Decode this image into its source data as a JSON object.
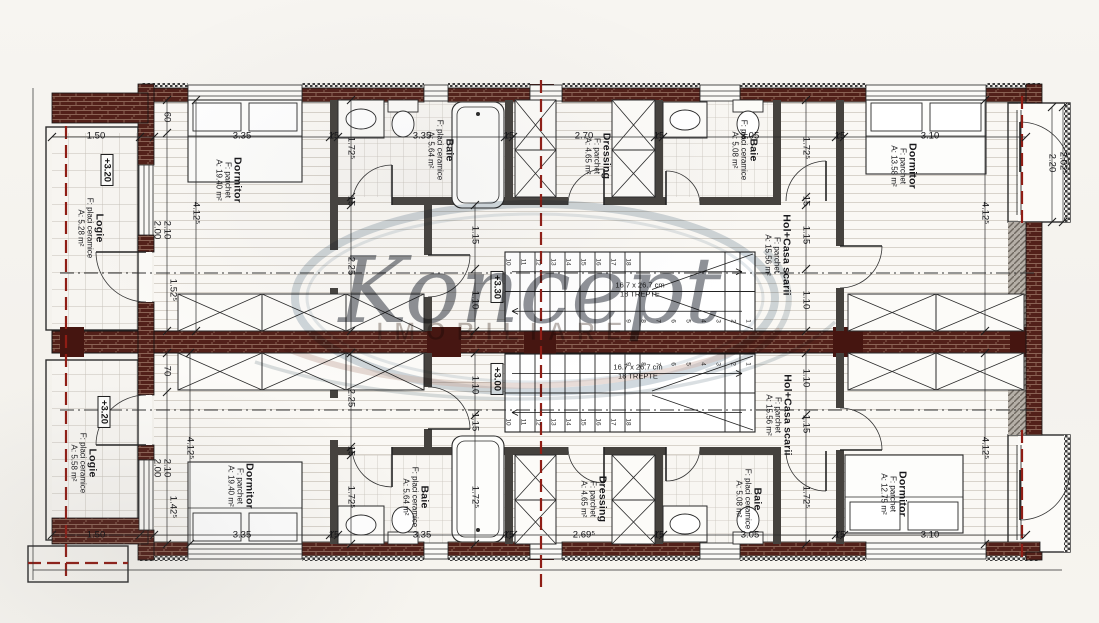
{
  "watermark": {
    "brand": "Koncept",
    "subtitle": "IMOBILIARE"
  },
  "plan": {
    "rooms": [
      {
        "id": "logie-top",
        "name": "Logie",
        "finish": "F: placi ceramice",
        "area": "A: 5.28 m²",
        "x": 90,
        "y": 228
      },
      {
        "id": "dormitor-top-left",
        "name": "Dormitor",
        "finish": "F: parchet",
        "area": "A: 19.40 m²",
        "x": 228,
        "y": 180
      },
      {
        "id": "baie-top-1",
        "name": "Baie",
        "finish": "F: placi ceramice",
        "area": "A: 5.64 m²",
        "x": 440,
        "y": 150
      },
      {
        "id": "dressing-top",
        "name": "Dressing",
        "finish": "F: parchet",
        "area": "A: 4.65 m²",
        "x": 597,
        "y": 156
      },
      {
        "id": "baie-top-2",
        "name": "Baie",
        "finish": "F: placi ceramice",
        "area": "A: 5.08 m²",
        "x": 744,
        "y": 150
      },
      {
        "id": "hol-top",
        "name": "Hol+Casa scarii",
        "finish": "F: parchet",
        "area": "A: 15.56 m²",
        "x": 777,
        "y": 255
      },
      {
        "id": "dormitor-top-right",
        "name": "Dormitor",
        "finish": "F: parchet",
        "area": "A: 13.58 m²",
        "x": 903,
        "y": 166
      },
      {
        "id": "logie-bottom",
        "name": "Logie",
        "finish": "F: placi ceramice",
        "area": "A: 5.58 m²",
        "x": 83,
        "y": 463
      },
      {
        "id": "dormitor-bottom-left",
        "name": "Dormitor",
        "finish": "F: parchet",
        "area": "A: 19.40 m²",
        "x": 240,
        "y": 486
      },
      {
        "id": "baie-bottom-1",
        "name": "Baie",
        "finish": "F: placi ceramice",
        "area": "A: 5.64 m²",
        "x": 415,
        "y": 497
      },
      {
        "id": "dressing-bottom",
        "name": "Dressing",
        "finish": "F: parchet",
        "area": "A: 4.65 m²",
        "x": 593,
        "y": 499
      },
      {
        "id": "baie-bottom-2",
        "name": "Baie",
        "finish": "F: placi ceramice",
        "area": "A: 5.08 m²",
        "x": 748,
        "y": 499
      },
      {
        "id": "hol-bottom",
        "name": "Hol+Casa scarii",
        "finish": "F: parchet",
        "area": "A: 15.56 m²",
        "x": 778,
        "y": 415
      },
      {
        "id": "dormitor-bottom-right",
        "name": "Dormitor",
        "finish": "F: parchet",
        "area": "A: 12.75 m²",
        "x": 893,
        "y": 494
      }
    ],
    "levels": [
      {
        "text": "+3.20",
        "x": 107,
        "y": 170
      },
      {
        "text": "+3.30",
        "x": 497,
        "y": 287
      },
      {
        "text": "+3.00",
        "x": 497,
        "y": 379
      },
      {
        "text": "+3.20",
        "x": 104,
        "y": 412
      }
    ],
    "stairs": {
      "tread_label": "16.7 x 26.7 cm",
      "steps_label": "18 TREPTE",
      "tread_count": 18,
      "notes": [
        {
          "x": 640,
          "y": 290
        },
        {
          "x": 638,
          "y": 372
        }
      ]
    },
    "dimensions": [
      {
        "t": "1.50",
        "x": 96,
        "y": 136
      },
      {
        "t": "3.35",
        "x": 242,
        "y": 136
      },
      {
        "t": "15",
        "x": 334,
        "y": 136
      },
      {
        "t": "3.35",
        "x": 422,
        "y": 136
      },
      {
        "t": "15",
        "x": 509,
        "y": 136
      },
      {
        "t": "2.70",
        "x": 584,
        "y": 136
      },
      {
        "t": "15",
        "x": 659,
        "y": 136
      },
      {
        "t": "3.05",
        "x": 750,
        "y": 136
      },
      {
        "t": "15",
        "x": 840,
        "y": 136
      },
      {
        "t": "3.10",
        "x": 930,
        "y": 136
      },
      {
        "t": "1.50",
        "x": 96,
        "y": 535
      },
      {
        "t": "3.35",
        "x": 242,
        "y": 535
      },
      {
        "t": "15",
        "x": 334,
        "y": 535
      },
      {
        "t": "3.35",
        "x": 422,
        "y": 535
      },
      {
        "t": "15",
        "x": 509,
        "y": 535
      },
      {
        "t": "2.69⁵",
        "x": 584,
        "y": 535
      },
      {
        "t": "15",
        "x": 659,
        "y": 535
      },
      {
        "t": "3.05",
        "x": 750,
        "y": 535
      },
      {
        "t": "15",
        "x": 840,
        "y": 535
      },
      {
        "t": "3.10",
        "x": 930,
        "y": 535
      },
      {
        "t": "60",
        "x": 167,
        "y": 117,
        "r": 1
      },
      {
        "t": "2.00",
        "x": 157,
        "y": 230,
        "r": 1
      },
      {
        "t": "2.10",
        "x": 167,
        "y": 230,
        "r": 1
      },
      {
        "t": "4.12⁵",
        "x": 196,
        "y": 213,
        "r": 1
      },
      {
        "t": "1.52⁵",
        "x": 173,
        "y": 290,
        "r": 1
      },
      {
        "t": "1.72⁵",
        "x": 351,
        "y": 148,
        "r": 1
      },
      {
        "t": "15",
        "x": 351,
        "y": 201,
        "r": 1
      },
      {
        "t": "2.25",
        "x": 351,
        "y": 266,
        "r": 1
      },
      {
        "t": "1.15",
        "x": 475,
        "y": 235,
        "r": 1
      },
      {
        "t": "1.10",
        "x": 475,
        "y": 300,
        "r": 1
      },
      {
        "t": "1.72⁵",
        "x": 806,
        "y": 148,
        "r": 1
      },
      {
        "t": "15",
        "x": 806,
        "y": 201,
        "r": 1
      },
      {
        "t": "1.15",
        "x": 806,
        "y": 235,
        "r": 1
      },
      {
        "t": "1.10",
        "x": 806,
        "y": 300,
        "r": 1
      },
      {
        "t": "4.12⁵",
        "x": 985,
        "y": 213,
        "r": 1
      },
      {
        "t": "2.20",
        "x": 1052,
        "y": 163,
        "r": 1
      },
      {
        "t": "2.02⁵",
        "x": 1063,
        "y": 163,
        "r": 1
      },
      {
        "t": "70",
        "x": 167,
        "y": 371,
        "r": 1
      },
      {
        "t": "2.00",
        "x": 157,
        "y": 468,
        "r": 1
      },
      {
        "t": "2.10",
        "x": 167,
        "y": 468,
        "r": 1
      },
      {
        "t": "4.12⁵",
        "x": 190,
        "y": 448,
        "r": 1
      },
      {
        "t": "1.42⁵",
        "x": 173,
        "y": 507,
        "r": 1
      },
      {
        "t": "2.25",
        "x": 351,
        "y": 398,
        "r": 1
      },
      {
        "t": "15",
        "x": 351,
        "y": 451,
        "r": 1
      },
      {
        "t": "1.72⁵",
        "x": 351,
        "y": 497,
        "r": 1
      },
      {
        "t": "1.10",
        "x": 475,
        "y": 385,
        "r": 1
      },
      {
        "t": "1.15",
        "x": 475,
        "y": 422,
        "r": 1
      },
      {
        "t": "1.72⁵",
        "x": 475,
        "y": 497,
        "r": 1
      },
      {
        "t": "1.10",
        "x": 806,
        "y": 378,
        "r": 1
      },
      {
        "t": "1.15",
        "x": 806,
        "y": 424,
        "r": 1
      },
      {
        "t": "1.72⁵",
        "x": 806,
        "y": 497,
        "r": 1
      },
      {
        "t": "4.12⁵",
        "x": 985,
        "y": 448,
        "r": 1
      }
    ]
  }
}
